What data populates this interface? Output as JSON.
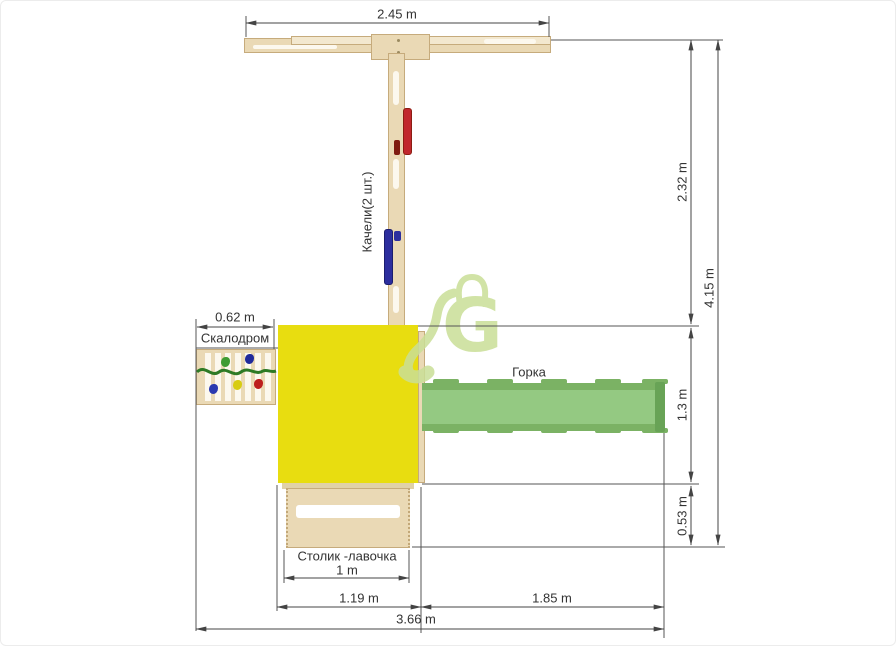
{
  "diagram": {
    "title": "Playground top-view layout drawing",
    "labels": {
      "swings": "Качели(2 шт.)",
      "climbing_wall": "Скалодром",
      "slide": "Горка",
      "table_bench": "Столик -лавочка"
    },
    "dimensions": {
      "beam_width": "2.45 m",
      "upper_height": "2.32 m",
      "total_height": "4.15 m",
      "platform_depth": "1.3 m",
      "bench_offset": "0.53 m",
      "climbing_wall_width": "0.62 m",
      "table_width": "1 m",
      "platform_width": "1.19 m",
      "slide_length": "1.85 m",
      "total_width": "3.66 m"
    },
    "colors": {
      "wood": "#ead9b5",
      "wood_border": "#c6ab7c",
      "wood_light": "#f3e8cf",
      "yellow": "#e8dd10",
      "slide": "#94c982",
      "slide_edge": "#7bb264",
      "slide_cap": "#68a356",
      "red": "#c1272d",
      "blue": "#2c2e9e",
      "rope": "#2e7a25",
      "watermark": "#cadf97",
      "dim_line": "#444444"
    }
  }
}
